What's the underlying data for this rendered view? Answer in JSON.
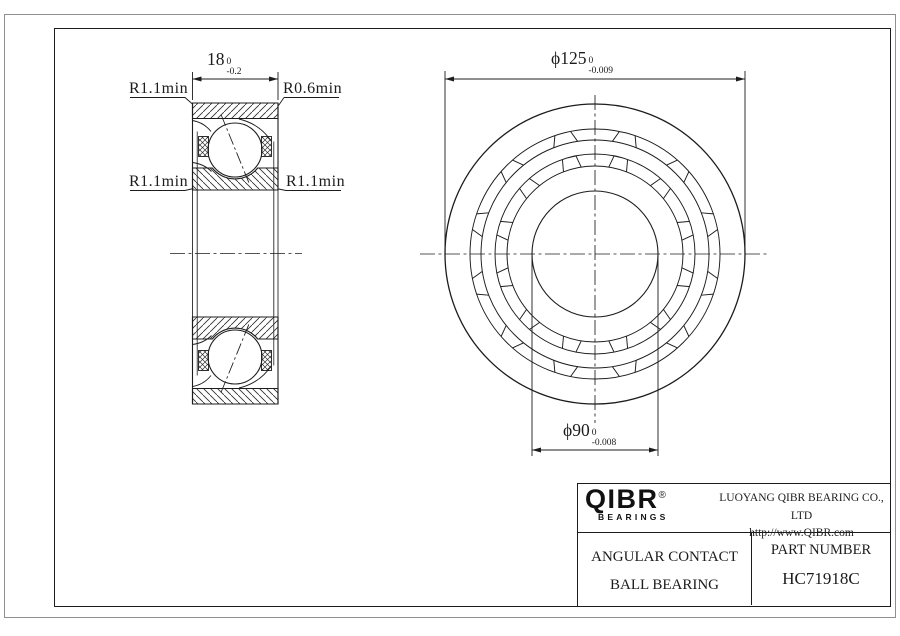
{
  "drawing": {
    "section_view": {
      "width_dim": {
        "value": "18",
        "tol_top": "0",
        "tol_bottom": "-0.2"
      },
      "fillet_top_left": "R1.1min",
      "fillet_top_right": "R0.6min",
      "fillet_mid_left": "R1.1min",
      "fillet_mid_right": "R1.1min"
    },
    "front_view": {
      "outer_dia": {
        "symbol": "ϕ",
        "value": "125",
        "tol_top": "0",
        "tol_bottom": "-0.009"
      },
      "bore_dia": {
        "symbol": "ϕ",
        "value": "90",
        "tol_top": "0",
        "tol_bottom": "-0.008"
      }
    }
  },
  "title_block": {
    "logo_text": "QIBR",
    "logo_reg": "®",
    "logo_sub": "BEARINGS",
    "company": "LUOYANG QIBR BEARING CO., LTD",
    "website": "http://www.QIBR.com",
    "product_line1": "ANGULAR CONTACT",
    "product_line2": "BALL BEARING",
    "part_label": "PART NUMBER",
    "part_number": "HC71918C"
  }
}
